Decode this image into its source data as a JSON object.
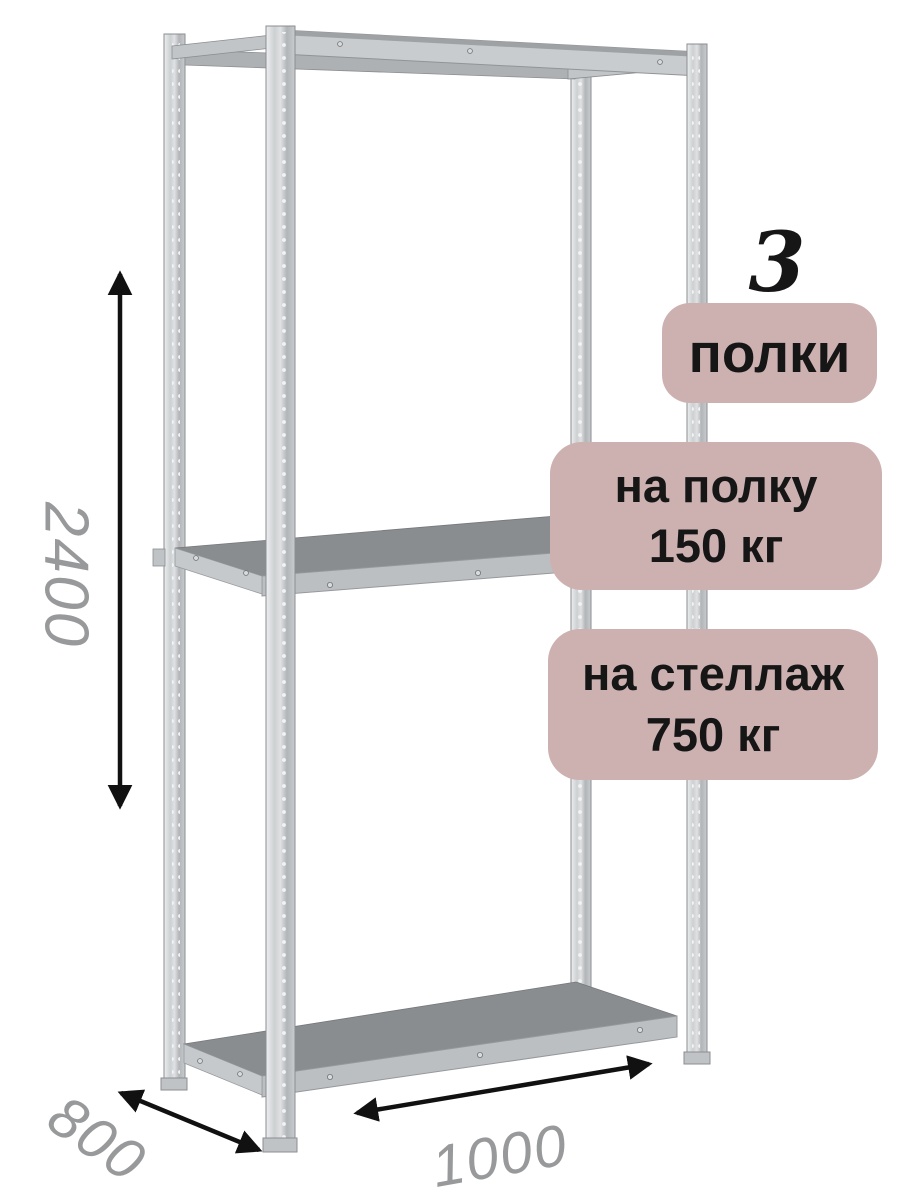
{
  "dimensions": {
    "height": "2400",
    "depth": "800",
    "width": "1000"
  },
  "badges": {
    "shelf_count": {
      "value": "3",
      "label": "полки"
    },
    "per_shelf": {
      "line1": "на полку",
      "line2": "150 кг"
    },
    "per_rack": {
      "line1": "на стеллаж",
      "line2": "750 кг"
    }
  },
  "illustration": {
    "subject": "metal-shelving-rack",
    "shelves": 3,
    "icons": [
      "height-arrow",
      "depth-arrow",
      "width-arrow"
    ]
  },
  "colors": {
    "badge-bg": "#ccb1b0",
    "badge-text": "#161616",
    "dimension-text": "#98999b",
    "arrow": "#111111",
    "metal-light": "#dcdee0",
    "metal-mid": "#bcbfc2",
    "metal-dark": "#898d90",
    "metal-outline": "#8b8e91",
    "background": "#ffffff"
  }
}
